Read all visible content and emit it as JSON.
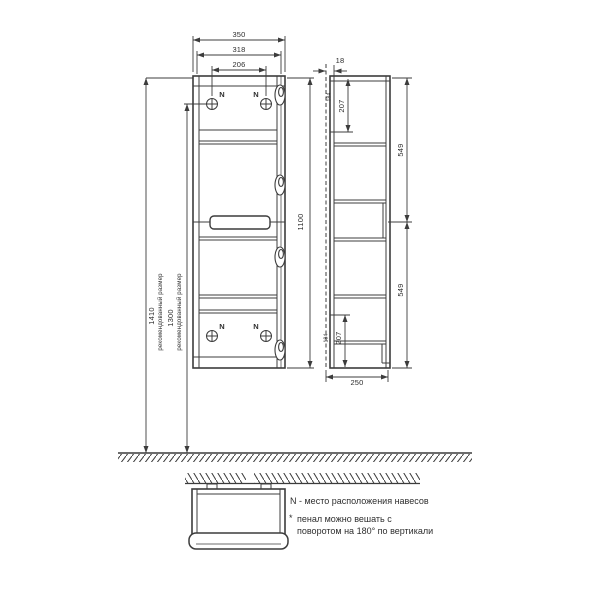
{
  "front_view": {
    "width_overall": "350",
    "width_inner": "318",
    "hanger_spacing": "206",
    "height_cabinet": "1100",
    "height_recommended": "1410",
    "height_recommended_label": "рекомендованный размер",
    "height_hangers": "1300",
    "height_hangers_label": "рекомендованный размер",
    "hanger_mark": "N"
  },
  "side_view": {
    "door_thickness": "18",
    "hanger_offset_top": "207",
    "hanger_offset_bottom": "207",
    "door_height_top": "549",
    "door_height_bottom": "549",
    "depth": "250",
    "hanger_inset_top": "184",
    "hanger_inset_bottom": "184"
  },
  "notes": {
    "hanger_note": "N - место расположения навесов",
    "footnote_marker": "*",
    "footnote_line1": "пенал можно вешать с",
    "footnote_line2": "поворотом на 180° по вертикали"
  }
}
